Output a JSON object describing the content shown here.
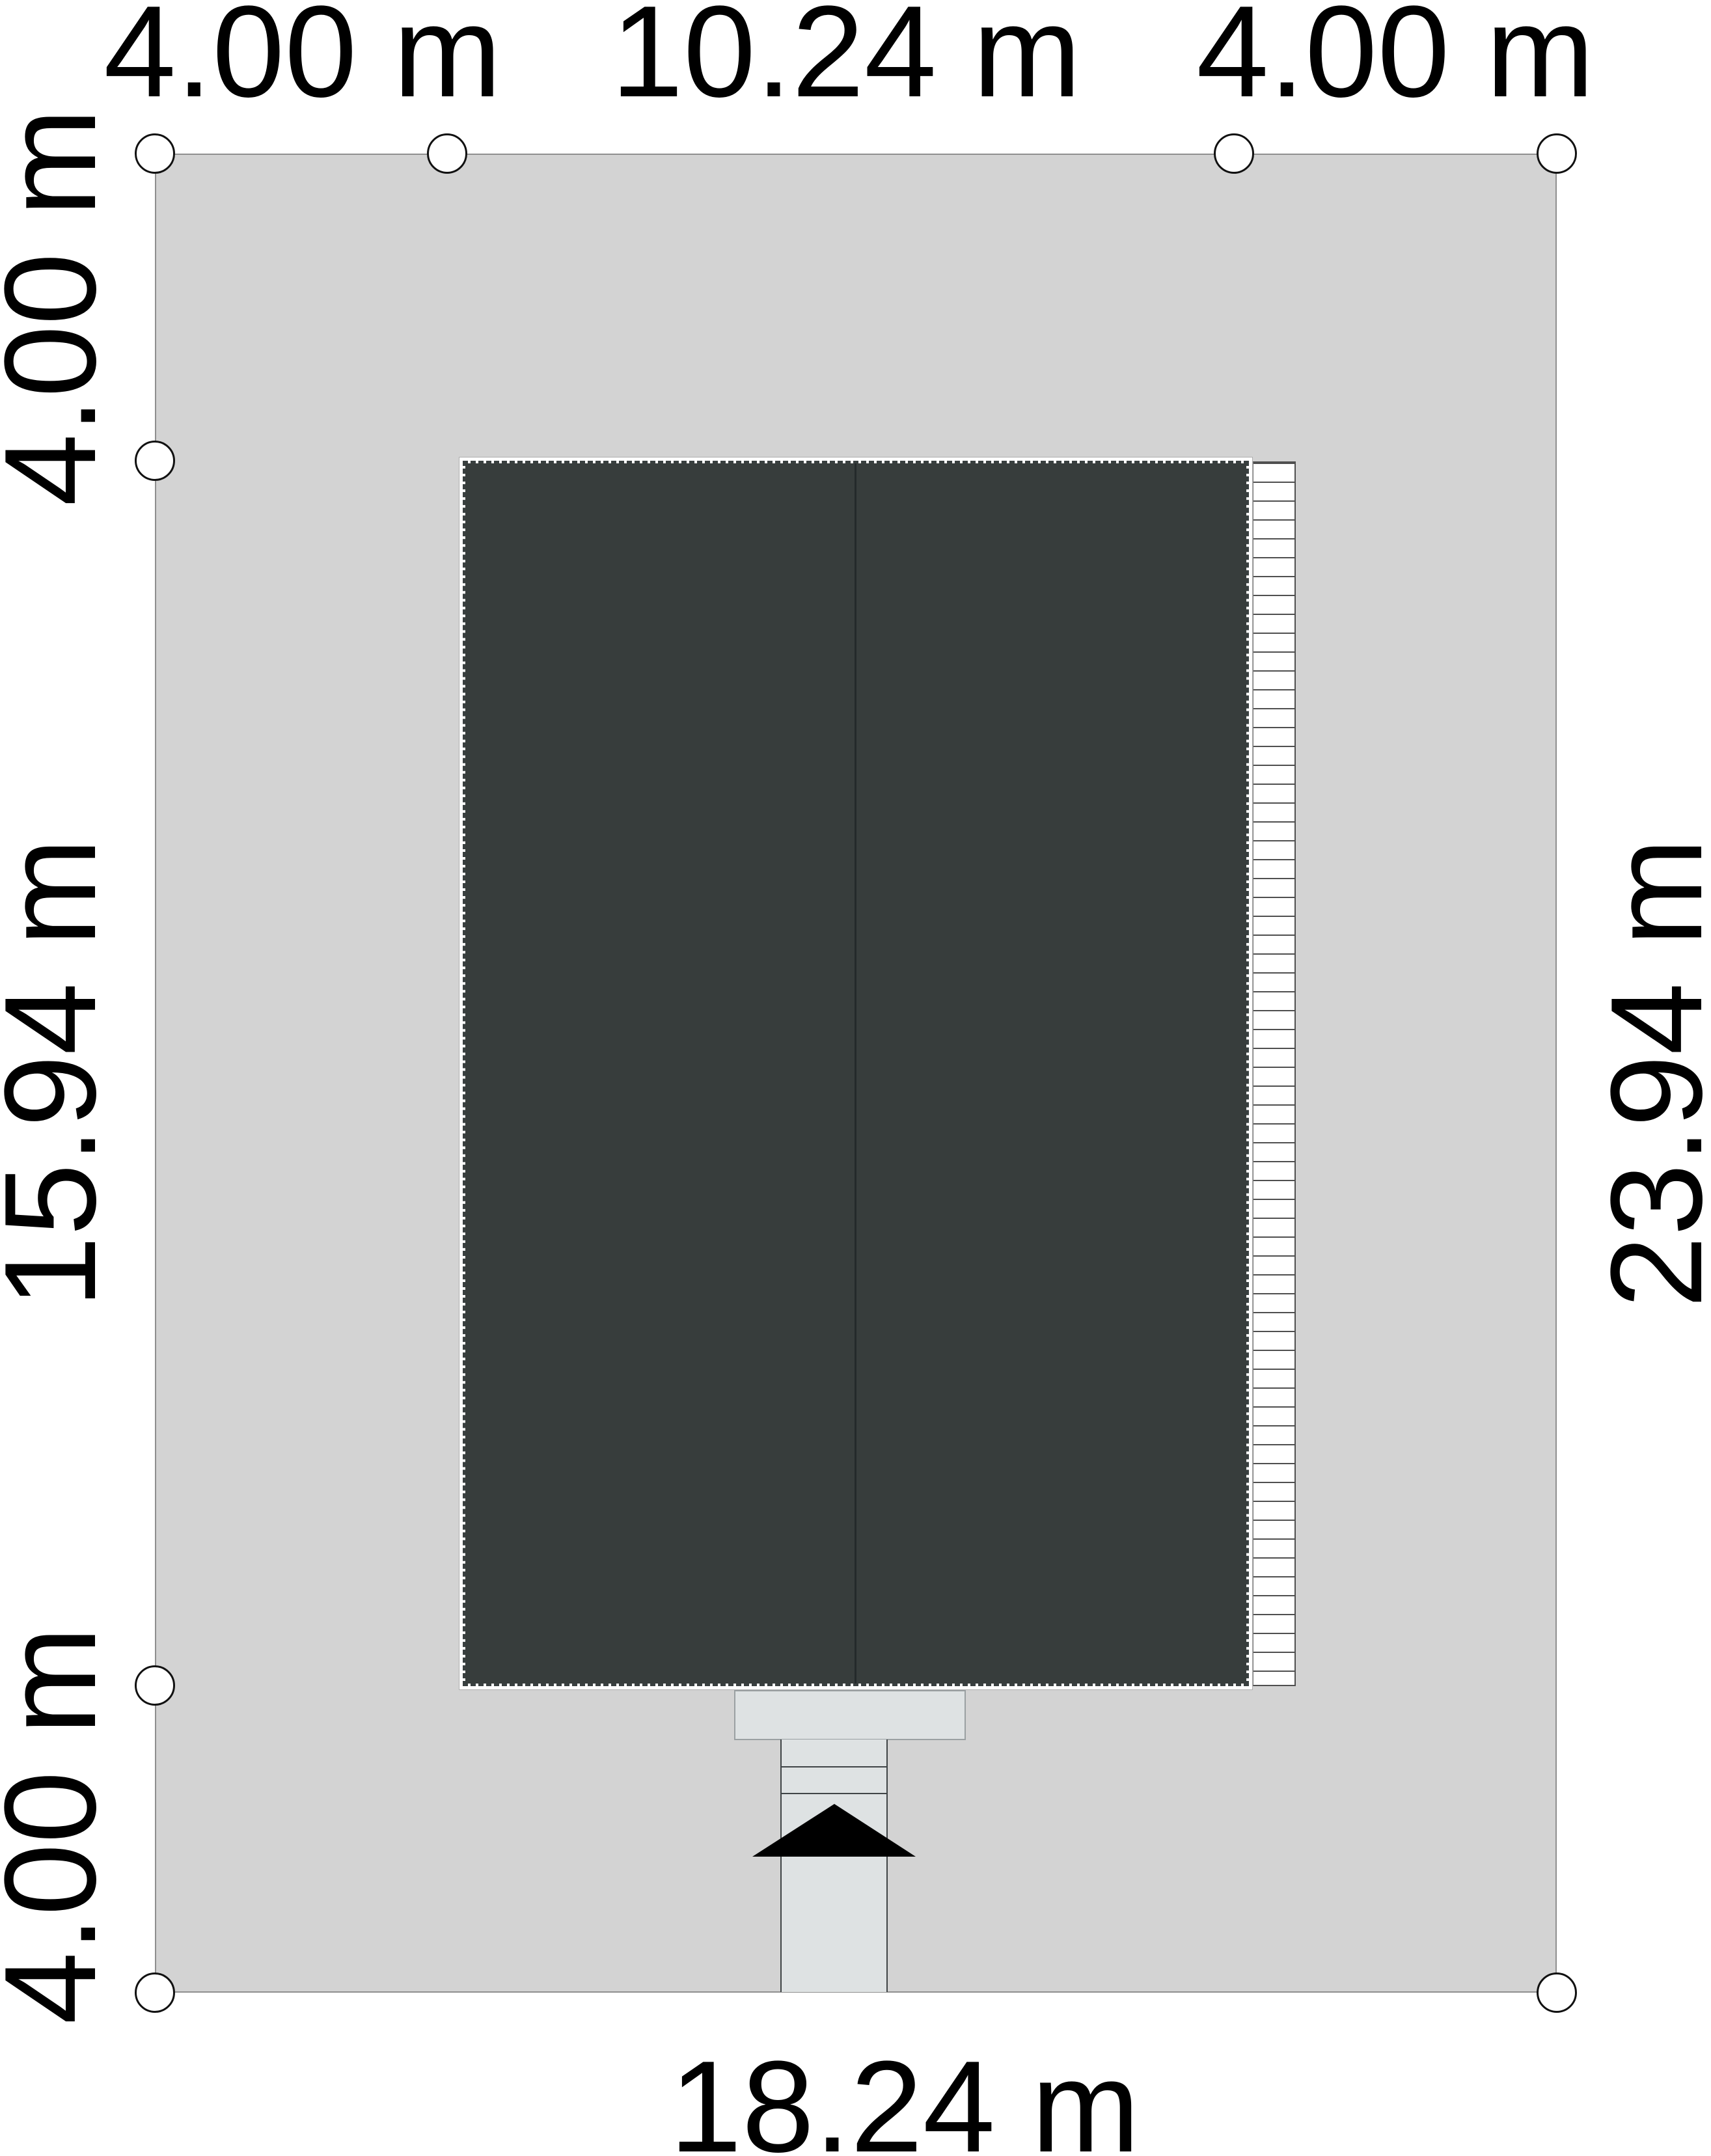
{
  "diagram_type": "architectural site plan (roof plan on plot)",
  "unit": "m",
  "labels": {
    "top_setback_left": "4.00 m",
    "top_building_width": "10.24 m",
    "top_setback_right": "4.00 m",
    "left_setback_top": "4.00 m",
    "left_building_depth": "15.94 m",
    "left_setback_bottom": "4.00 m",
    "right_plot_depth": "23.94 m",
    "bottom_plot_width": "18.24 m"
  },
  "dimensions": {
    "plot_width_m": 18.24,
    "plot_depth_m": 23.94,
    "building_width_m": 10.24,
    "building_depth_m": 15.94,
    "setback_m": 4.0
  },
  "colors": {
    "plot": "#d3d3d3",
    "roof": "#373d3c",
    "roof-dash": "#394040",
    "ridge": "#242a2b",
    "paving": "#dee2e3",
    "arrow": "#000000"
  }
}
